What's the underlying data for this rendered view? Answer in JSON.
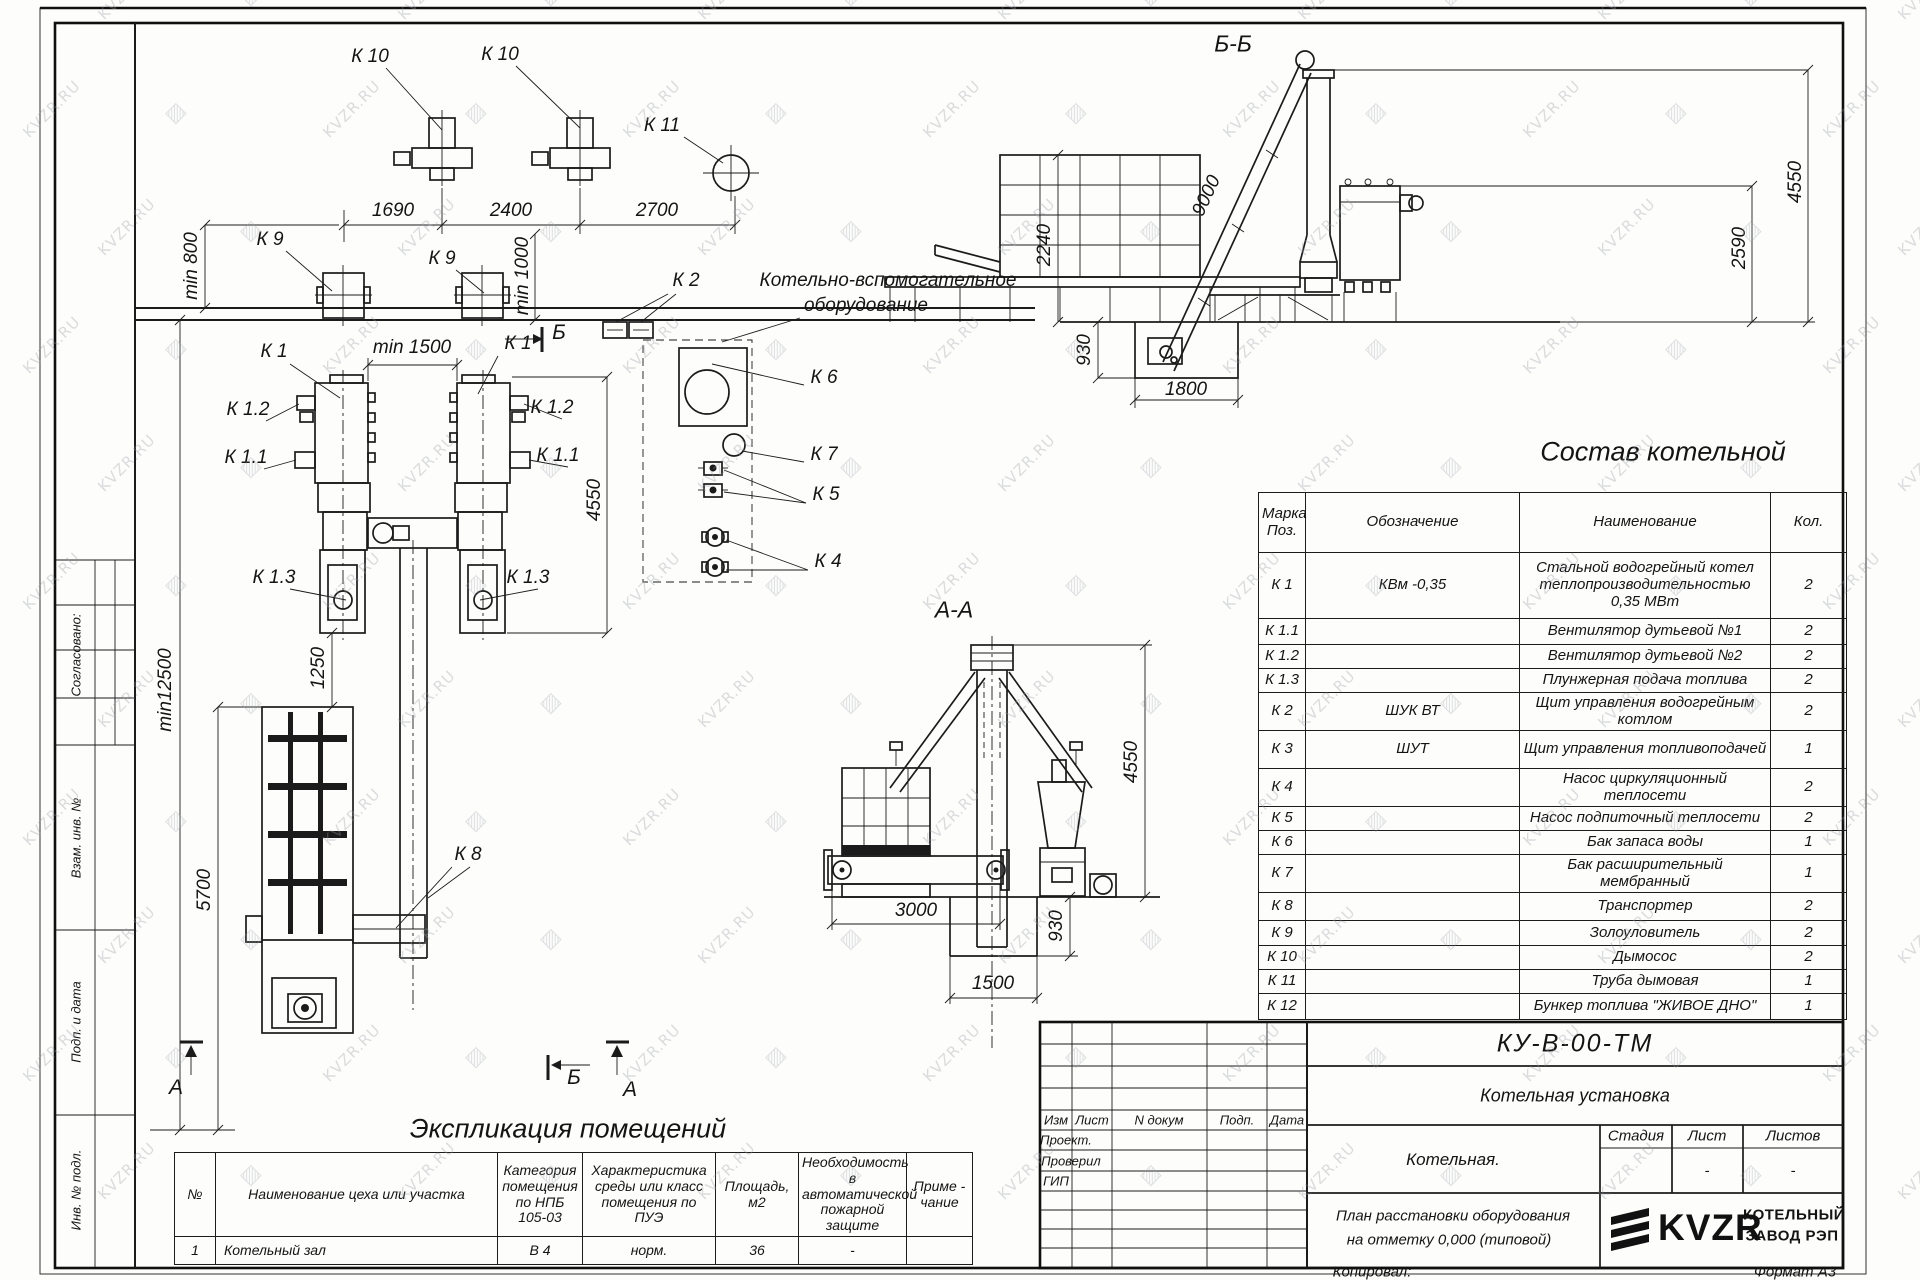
{
  "watermark": {
    "text": "KVZR.RU"
  },
  "margin": {
    "approved": "Согласовано:",
    "vzam": "Взам. инв. №",
    "podp_data": "Подп. и дата",
    "inv": "Инв. № подл."
  },
  "plan": {
    "labels": {
      "k1": "К 1",
      "k1_1": "К 1.1",
      "k1_2": "К 1.2",
      "k1_3": "К 1.3",
      "k2": "К 2",
      "k4": "К 4",
      "k5": "К 5",
      "k6": "К 6",
      "k7": "К 7",
      "k8": "К 8",
      "k9": "К 9",
      "k10": "К 10",
      "k11": "К 11"
    },
    "aux_note_line1": "Котельно-вспомогательное",
    "aux_note_line2": "оборудование",
    "dims": {
      "d1690": "1690",
      "d2400": "2400",
      "d2700": "2700",
      "min800": "min 800",
      "min1000": "min 1000",
      "min1500": "min 1500",
      "d4550": "4550",
      "min12500": "min12500",
      "d5700": "5700",
      "d1250": "1250"
    },
    "marker_a": "А",
    "marker_b": "Б"
  },
  "section_bb": {
    "title": "Б-Б",
    "dims": {
      "d9000": "9000",
      "d2240": "2240",
      "d930": "930",
      "d1800": "1800",
      "d2590": "2590",
      "d4550": "4550"
    }
  },
  "section_aa": {
    "title": "А-А",
    "dims": {
      "d3000": "3000",
      "d930": "930",
      "d1500": "1500",
      "d4550": "4550"
    }
  },
  "sostav": {
    "title": "Состав котельной",
    "headers": {
      "mark": "Марка Поз.",
      "designation": "Обозначение",
      "name": "Наименование",
      "qty": "Кол."
    },
    "rows": [
      {
        "mark": "К 1",
        "designation": "КВм -0,35",
        "name": "Стальной водогрейный котел теплопроизводительностью 0,35 МВт",
        "qty": "2"
      },
      {
        "mark": "К 1.1",
        "designation": "",
        "name": "Вентилятор дутьевой  №1",
        "qty": "2"
      },
      {
        "mark": "К 1.2",
        "designation": "",
        "name": "Вентилятор дутьевой  №2",
        "qty": "2"
      },
      {
        "mark": "К 1.3",
        "designation": "",
        "name": "Плунжерная подача топлива",
        "qty": "2"
      },
      {
        "mark": "К 2",
        "designation": "ШУК ВТ",
        "name": "Щит управления водогрейным котлом",
        "qty": "2"
      },
      {
        "mark": "К 3",
        "designation": "ШУТ",
        "name": "Щит управления топливоподачей",
        "qty": "1"
      },
      {
        "mark": "К 4",
        "designation": "",
        "name": "Насос циркуляционный теплосети",
        "qty": "2"
      },
      {
        "mark": "К 5",
        "designation": "",
        "name": "Насос подпиточный теплосети",
        "qty": "2"
      },
      {
        "mark": "К 6",
        "designation": "",
        "name": "Бак запаса воды",
        "qty": "1"
      },
      {
        "mark": "К 7",
        "designation": "",
        "name": "Бак расширительный мембранный",
        "qty": "1"
      },
      {
        "mark": "К 8",
        "designation": "",
        "name": "Транспортер",
        "qty": "2"
      },
      {
        "mark": "К 9",
        "designation": "",
        "name": "Золоуловитель",
        "qty": "2"
      },
      {
        "mark": "К 10",
        "designation": "",
        "name": "Дымосос",
        "qty": "2"
      },
      {
        "mark": "К 11",
        "designation": "",
        "name": "Труба дымовая",
        "qty": "1"
      },
      {
        "mark": "К 12",
        "designation": "",
        "name": "Бункер топлива  \"ЖИВОЕ ДНО\"",
        "qty": "1"
      }
    ]
  },
  "explication": {
    "title": "Экспликация помещений",
    "headers": {
      "num": "№",
      "name": "Наименование цеха или участка",
      "category": "Категория помещения по НПБ 105-03",
      "env": "Характеристика среды или класс помещения по ПУЭ",
      "area": "Площадь, м2",
      "fire": "Необходимость в автоматической пожарной защите",
      "note": "Приме - чание"
    },
    "row": {
      "num": "1",
      "name": "Котельный зал",
      "category": "В 4",
      "env": "норм.",
      "area": "36",
      "fire": "-",
      "note": ""
    }
  },
  "titleblock": {
    "doc_number": "КУ-В-00-ТМ",
    "project_title": "Котельная установка",
    "object": "Котельная.",
    "sheet_title_line1": "План расстановки оборудования",
    "sheet_title_line2": "на отметку 0,000 (типовой)",
    "cols": {
      "izm": "Изм",
      "list": "Лист",
      "ndoc": "N докум",
      "podp": "Подп.",
      "data": "Дата"
    },
    "roles": {
      "proekt": "Проект.",
      "proveril": "Проверил",
      "gip": "ГИП"
    },
    "stage_header": {
      "stage": "Стадия",
      "sheet": "Лист",
      "sheets": "Листов"
    },
    "stage_values": {
      "sheet": "-",
      "sheets": "-"
    },
    "logo_text": "KVZR",
    "company_line1": "КОТЕЛЬНЫЙ",
    "company_line2": "ЗАВОД РЭП",
    "copied": "Копировал:",
    "format": "Формат А3"
  }
}
